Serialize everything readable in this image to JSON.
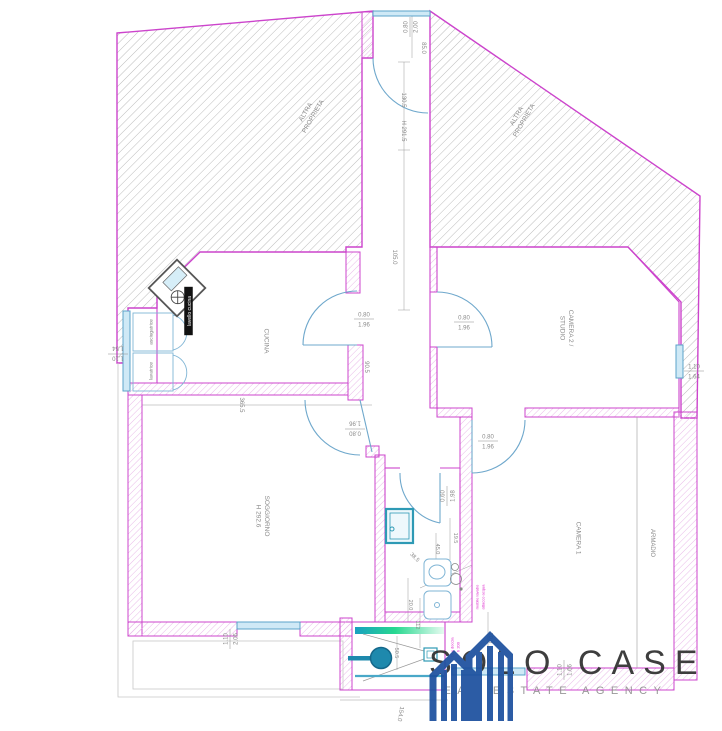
{
  "logo": {
    "name": "SOLO CASE",
    "tagline": "REAL ESTATE AGENCY"
  },
  "colors": {
    "plan_magenta": "#cc44cc",
    "hatch_gray": "#b4b4b4",
    "blue": "#5ba3c9",
    "teal": "#1e89ad",
    "dim_text": "#8a8a8a",
    "room_text": "#8a8a8a",
    "note_magenta": "#dd22cc",
    "logo_blue": "#1b4f9e"
  },
  "labels": [
    {
      "id": "room-label-cucina",
      "kind": "room",
      "lines": [
        "CUCINA"
      ],
      "x": 267,
      "y": 341,
      "rot": 90,
      "size": 6.5
    },
    {
      "id": "room-label-soggiorno",
      "kind": "room",
      "lines": [
        "SOGGIORNO",
        "H 292.6"
      ],
      "x": 263,
      "y": 516,
      "rot": 90,
      "size": 6.5
    },
    {
      "id": "room-label-camera2-studio",
      "kind": "room",
      "lines": [
        "CAMERA 2 /",
        "STUDIO"
      ],
      "x": 567,
      "y": 328,
      "rot": 90,
      "size": 6.5
    },
    {
      "id": "room-label-camera1",
      "kind": "room",
      "lines": [
        "CAMERA 1"
      ],
      "x": 579,
      "y": 538,
      "rot": 90,
      "size": 6.5
    },
    {
      "id": "room-label-armadio",
      "kind": "room",
      "lines": [
        "ARMADIO"
      ],
      "x": 653,
      "y": 543,
      "rot": 90,
      "size": 6
    },
    {
      "id": "area-label-altra-proprieta-left",
      "kind": "room",
      "lines": [
        "ALTRA",
        "PROPRIETA"
      ],
      "x": 309,
      "y": 114,
      "rot": -60,
      "size": 6.5
    },
    {
      "id": "area-label-altra-proprieta-right",
      "kind": "room",
      "lines": [
        "ALTRA",
        "PROPRIETA"
      ],
      "x": 520,
      "y": 118,
      "rot": -60,
      "size": 6.5
    },
    {
      "id": "appliance-label-lavello-cucina",
      "kind": "appliance",
      "lines": [
        "lavello cucina"
      ],
      "x": 189,
      "y": 311,
      "rot": -90,
      "size": 5,
      "inverted": true
    },
    {
      "id": "appliance-label-asciugatrice",
      "kind": "appliance",
      "lines": [
        "asciugatrice"
      ],
      "x": 151,
      "y": 332,
      "rot": -90,
      "size": 4.8,
      "color": "#777777"
    },
    {
      "id": "appliance-label-lavatrice",
      "kind": "appliance",
      "lines": [
        "lavatrice"
      ],
      "x": 151,
      "y": 371,
      "rot": -90,
      "size": 4.8,
      "color": "#777777"
    },
    {
      "id": "dim-entrance-door",
      "kind": "dim2",
      "lines": [
        "0.80",
        "2.00"
      ],
      "x": 410,
      "y": 27,
      "rot": -90,
      "size": 6
    },
    {
      "id": "dim-entrance-85",
      "kind": "dim",
      "lines": [
        "85.0"
      ],
      "x": 424,
      "y": 48,
      "rot": 90,
      "size": 6
    },
    {
      "id": "dim-corridor-130",
      "kind": "dim",
      "lines": [
        "130.5"
      ],
      "x": 404,
      "y": 100,
      "rot": 90,
      "size": 6
    },
    {
      "id": "dim-corridor-h291",
      "kind": "dim",
      "lines": [
        "H 291.5"
      ],
      "x": 404,
      "y": 131,
      "rot": 90,
      "size": 6
    },
    {
      "id": "dim-corridor-105",
      "kind": "dim",
      "lines": [
        "105.0"
      ],
      "x": 395,
      "y": 257,
      "rot": 90,
      "size": 6
    },
    {
      "id": "dim-kitchen-door",
      "kind": "dim2",
      "lines": [
        "0.80",
        "1.96"
      ],
      "x": 364,
      "y": 319,
      "rot": 0,
      "size": 6
    },
    {
      "id": "dim-hall-90",
      "kind": "dim",
      "lines": [
        "90.5"
      ],
      "x": 367,
      "y": 367,
      "rot": 90,
      "size": 6
    },
    {
      "id": "dim-soggiorno-door",
      "kind": "dim2",
      "lines": [
        "0.80",
        "1.96"
      ],
      "x": 355,
      "y": 429,
      "rot": 180,
      "size": 6
    },
    {
      "id": "dim-camera2-door",
      "kind": "dim2",
      "lines": [
        "0.80",
        "1.96"
      ],
      "x": 464,
      "y": 322,
      "rot": 0,
      "size": 6
    },
    {
      "id": "dim-camera1-door",
      "kind": "dim2",
      "lines": [
        "0.80",
        "1.96"
      ],
      "x": 488,
      "y": 441,
      "rot": 0,
      "size": 6
    },
    {
      "id": "dim-bagno-door",
      "kind": "dim2",
      "lines": [
        "0.60",
        "1.98"
      ],
      "x": 447,
      "y": 496,
      "rot": -90,
      "size": 6
    },
    {
      "id": "dim-soggiorno-365",
      "kind": "dim",
      "lines": [
        "365.5"
      ],
      "x": 242,
      "y": 405,
      "rot": 90,
      "size": 6
    },
    {
      "id": "dim-window-left",
      "kind": "dim2",
      "lines": [
        "1.10",
        "1.54"
      ],
      "x": 118,
      "y": 354,
      "rot": 180,
      "size": 6
    },
    {
      "id": "dim-window-soggiorno",
      "kind": "dim2",
      "lines": [
        "1.10",
        "2.06"
      ],
      "x": 230,
      "y": 639,
      "rot": -90,
      "size": 6
    },
    {
      "id": "dim-window-camera2",
      "kind": "dim2",
      "lines": [
        "1.10",
        "1.64"
      ],
      "x": 694,
      "y": 371,
      "rot": 0,
      "size": 6
    },
    {
      "id": "dim-window-camera1",
      "kind": "dim2",
      "lines": [
        "1.10",
        "1.66"
      ],
      "x": 564,
      "y": 670,
      "rot": -90,
      "size": 6
    },
    {
      "id": "dim-bagno-19",
      "kind": "dim",
      "lines": [
        "19.5"
      ],
      "x": 456,
      "y": 538,
      "rot": 90,
      "size": 5.5
    },
    {
      "id": "dim-bagno-45",
      "kind": "dim",
      "lines": [
        "45.0"
      ],
      "x": 438,
      "y": 549,
      "rot": 90,
      "size": 5.5
    },
    {
      "id": "dim-bagno-38",
      "kind": "dim",
      "lines": [
        "38.5"
      ],
      "x": 415,
      "y": 557,
      "rot": 45,
      "size": 5.5
    },
    {
      "id": "dim-bagno-20",
      "kind": "dim",
      "lines": [
        "20.0"
      ],
      "x": 411,
      "y": 605,
      "rot": 90,
      "size": 5.5
    },
    {
      "id": "dim-bagno-112",
      "kind": "dim",
      "lines": [
        "112"
      ],
      "x": 418,
      "y": 625,
      "rot": 90,
      "size": 5.5
    },
    {
      "id": "dim-doccia-50",
      "kind": "dim",
      "lines": [
        "50.5"
      ],
      "x": 397,
      "y": 653,
      "rot": 90,
      "size": 5.5
    },
    {
      "id": "dim-camera1-20",
      "kind": "dim",
      "lines": [
        "20.0"
      ],
      "x": 491,
      "y": 638,
      "rot": 90,
      "size": 5.5
    },
    {
      "id": "dim-doccia-154",
      "kind": "dim",
      "lines": [
        "154.0"
      ],
      "x": 401,
      "y": 714,
      "rot": 100,
      "size": 6
    },
    {
      "id": "note-mobile-lavabo",
      "kind": "note",
      "lines": [
        "mobile lavabo",
        "attacco acqua"
      ],
      "x": 480,
      "y": 597,
      "rot": -90,
      "size": 4
    },
    {
      "id": "note-box-doccia",
      "kind": "note",
      "lines": [
        "box doccia",
        "h 200"
      ],
      "x": 455,
      "y": 647,
      "rot": -90,
      "size": 4
    }
  ]
}
